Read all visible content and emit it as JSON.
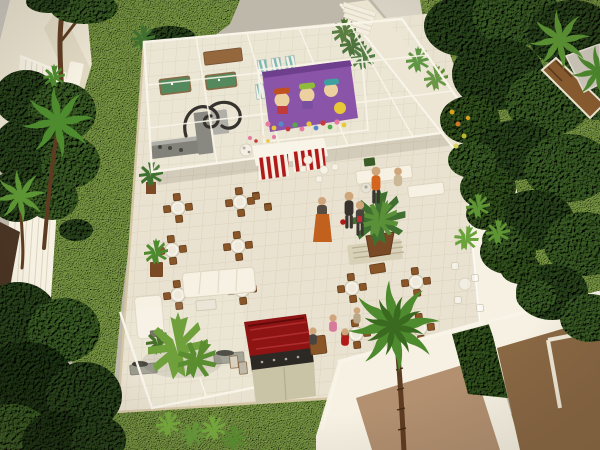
{
  "image": {
    "width": 600,
    "height": 450,
    "kind": "photograph",
    "subject": "Architectural scale model of a condominium leisure terrace, viewed from a high angle",
    "visible_text": ""
  },
  "scene": {
    "areas": [
      {
        "name": "glass-pavilion",
        "contains": [
          "wood-bench",
          "pool-tables",
          "striped-loungers",
          "kitchen-counters",
          "wrought-iron-scroll"
        ]
      },
      {
        "name": "kids-play-area",
        "detail": "purple mural wall with cartoon characters and pile of colorful toys"
      },
      {
        "name": "candy-counter",
        "detail": "white counter with red-and-white striped banners"
      },
      {
        "name": "dining-terrace",
        "detail": "wooden chair + round glass table sets on cream tiles"
      },
      {
        "name": "lounge-area",
        "detail": "white sofas, stone pedestals, big yucca plant"
      },
      {
        "name": "grill-station",
        "detail": "dark red roofed barbecue counter"
      },
      {
        "name": "raised-walkway",
        "detail": "white ramp along right edge with hedge"
      },
      {
        "name": "perimeter-gardens",
        "detail": "lawns, dark model trees, palms, pergola, white fences and walls"
      }
    ],
    "counts": {
      "dining_sets_left": 6,
      "dining_sets_right": 4,
      "ghost_chairs": 4,
      "standing_figures": 4,
      "seated_figures": 5,
      "palm_trees": 4,
      "pool_tables": 2,
      "cartoon_characters": 3
    }
  },
  "palette": {
    "base": "#beb8aa",
    "street": "#cac6be",
    "wallCream": "#ebe4d1",
    "wallLight": "#f6f1e2",
    "wallShade": "#dcd3bb",
    "white": "#f8f4e8",
    "tile": "#e9e2d0",
    "tileLine": "#d8cfb6",
    "grass": "#7d9c46",
    "grassDark": "#5a7a32",
    "leafDark": "#2b461d",
    "leafMid": "#3c5e26",
    "leafBright": "#67983a",
    "hedge": "#34531f",
    "palmGreen": "#4e8a2e",
    "trunk": "#5e3c22",
    "wood": "#8a5628",
    "woodDark": "#643f1e",
    "steel": "#a8a8a0",
    "counter": "#74746c",
    "red": "#b21a1a",
    "grillRed": "#8e1414",
    "purple": "#8a55a8",
    "teal": "#6fb2aa",
    "poolGreen": "#417c4b",
    "skin": "#cfa57c",
    "orange": "#d4651f",
    "suit": "#37322c",
    "tan": "#b29070",
    "brownFace": "#8a6844",
    "stone": "#9a9a8c",
    "pot": "#7a4a26"
  }
}
